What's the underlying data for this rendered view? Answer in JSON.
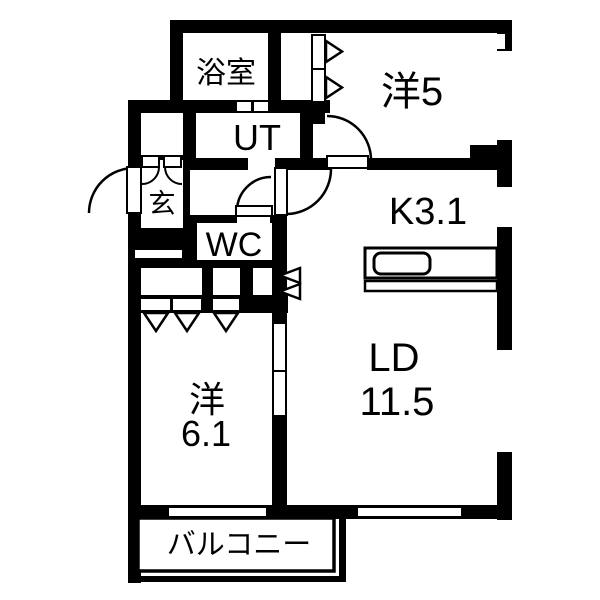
{
  "page": {
    "kind": "apartment-floorplan-diagram",
    "background": "#ffffff"
  },
  "colors": {
    "wall": "#000000",
    "floor": "#ffffff",
    "text": "#000000"
  },
  "rooms": {
    "bathroom": {
      "label": "浴室"
    },
    "utility": {
      "label": "UT"
    },
    "entrance": {
      "label": "玄"
    },
    "toilet": {
      "label": "WC"
    },
    "western_room_5": {
      "label": "洋5"
    },
    "kitchen": {
      "label": "K3.1"
    },
    "living_dining": {
      "line1": "LD",
      "line2": "11.5"
    },
    "western_room_6": {
      "line1": "洋",
      "line2": "6.1"
    },
    "balcony": {
      "label": "バルコニー"
    }
  }
}
